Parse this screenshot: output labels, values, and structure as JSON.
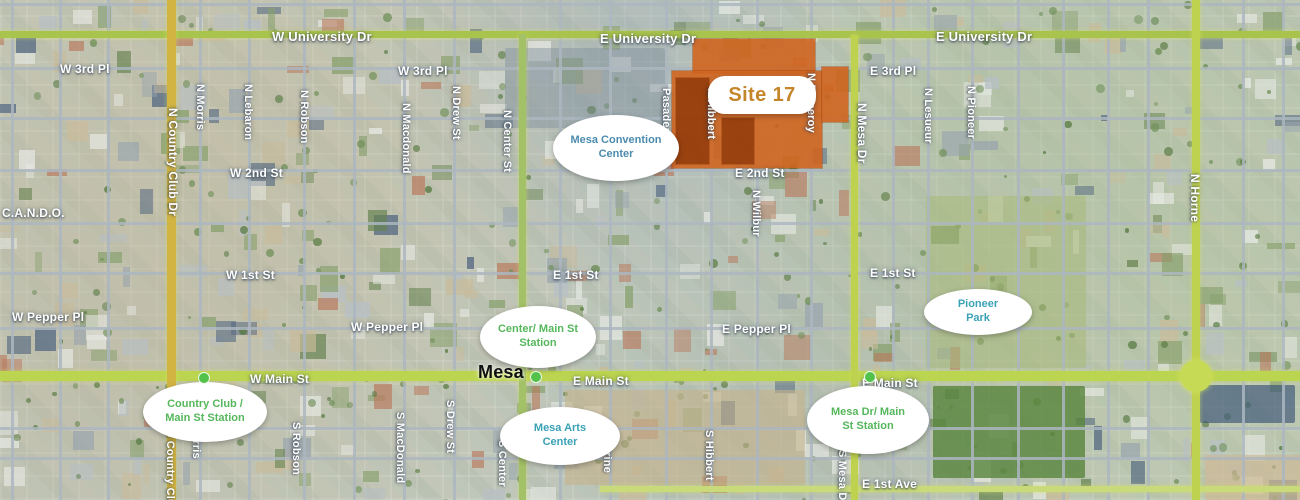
{
  "map": {
    "colors": {
      "site_fill": "#d2631c",
      "site_dark": "#933c0c",
      "site_label_text": "#c5862b",
      "station_green": "#56b75c",
      "station_dot": "#53c24a",
      "teal_label": "#3ba2b5",
      "convention_blue": "#4c8bad",
      "main_road": "#bcd550",
      "university_road": "#a9c44d",
      "gold_road": "#d2b442",
      "minor_road": "#acb6c0"
    },
    "site": {
      "label": "Site 17",
      "label_x": 762,
      "label_y": 95,
      "label_w": 92,
      "label_h": 34,
      "rects": [
        {
          "x": 693,
          "y": 39,
          "w": 122,
          "h": 34,
          "tone": "fill"
        },
        {
          "x": 672,
          "y": 71,
          "w": 150,
          "h": 97,
          "tone": "fill"
        },
        {
          "x": 822,
          "y": 67,
          "w": 26,
          "h": 55,
          "tone": "fill"
        },
        {
          "x": 676,
          "y": 78,
          "w": 33,
          "h": 86,
          "tone": "dark"
        },
        {
          "x": 722,
          "y": 118,
          "w": 32,
          "h": 46,
          "tone": "dark"
        }
      ]
    },
    "roads": [
      {
        "name": "university-dr",
        "dir": "h",
        "x": 0,
        "y": 31,
        "len": 1300,
        "th": 7,
        "color": "#a9c44d"
      },
      {
        "name": "main-st",
        "dir": "h",
        "x": 0,
        "y": 371,
        "len": 1300,
        "th": 10,
        "color": "#bcd550"
      },
      {
        "name": "e-1st-ave",
        "dir": "h",
        "x": 600,
        "y": 486,
        "len": 700,
        "th": 6,
        "color": "#c8da7a"
      },
      {
        "name": "country-club-dr",
        "dir": "v",
        "x": 167,
        "y": 0,
        "len": 500,
        "th": 9,
        "color": "#d2b442"
      },
      {
        "name": "center-st",
        "dir": "v",
        "x": 519,
        "y": 34,
        "len": 466,
        "th": 7,
        "color": "#a3c167"
      },
      {
        "name": "mesa-dr",
        "dir": "v",
        "x": 851,
        "y": 35,
        "len": 465,
        "th": 7,
        "color": "#bfd24f"
      },
      {
        "name": "horne",
        "dir": "v",
        "x": 1192,
        "y": 0,
        "len": 500,
        "th": 8,
        "color": "#bfd24f"
      }
    ],
    "roundabout": {
      "name": "main-horne-interchange",
      "x": 1196,
      "y": 376,
      "r": 16,
      "color": "#c6da55"
    },
    "grid": {
      "vertical_x": [
        12,
        60,
        108,
        200,
        249,
        304,
        354,
        404,
        454,
        560,
        610,
        666,
        711,
        757,
        811,
        893,
        928,
        972,
        1018,
        1063,
        1108,
        1148,
        1243,
        1283
      ],
      "horizontal_y": [
        4,
        68,
        118,
        170,
        223,
        273,
        328,
        428,
        458
      ]
    },
    "areas": [
      {
        "name": "convention-center-block",
        "x": 505,
        "y": 48,
        "w": 160,
        "h": 80,
        "color": "rgba(128,144,158,0.45)",
        "pattern": ""
      },
      {
        "name": "pioneer-park-area",
        "x": 926,
        "y": 196,
        "w": 160,
        "h": 172,
        "color": "rgba(168,185,120,0.55)",
        "pattern": "park"
      },
      {
        "name": "temple-gardens",
        "x": 933,
        "y": 386,
        "w": 152,
        "h": 92,
        "color": "rgba(88,132,60,0.80)",
        "pattern": "grid"
      },
      {
        "name": "vacant-lot",
        "x": 565,
        "y": 390,
        "w": 240,
        "h": 95,
        "color": "rgba(199,178,138,0.60)",
        "pattern": ""
      },
      {
        "name": "dark-roof-cluster",
        "x": 1200,
        "y": 385,
        "w": 95,
        "h": 38,
        "color": "rgba(58,84,120,0.65)",
        "pattern": ""
      },
      {
        "name": "dirt-field",
        "x": 1205,
        "y": 455,
        "w": 95,
        "h": 45,
        "color": "rgba(205,185,150,0.70)",
        "pattern": ""
      }
    ],
    "street_labels": [
      {
        "text": "W University Dr",
        "x": 272,
        "y": 29,
        "dir": "h",
        "size": 13,
        "style": "road"
      },
      {
        "text": "E University Dr",
        "x": 600,
        "y": 31,
        "dir": "h",
        "size": 13,
        "style": "road"
      },
      {
        "text": "E University Dr",
        "x": 936,
        "y": 29,
        "dir": "h",
        "size": 13,
        "style": "road"
      },
      {
        "text": "W 3rd Pl",
        "x": 60,
        "y": 62,
        "dir": "h",
        "size": 12,
        "style": "road"
      },
      {
        "text": "W 3rd Pl",
        "x": 398,
        "y": 64,
        "dir": "h",
        "size": 12,
        "style": "road"
      },
      {
        "text": "E 3rd Pl",
        "x": 870,
        "y": 64,
        "dir": "h",
        "size": 12,
        "style": "road"
      },
      {
        "text": "W 2nd St",
        "x": 230,
        "y": 166,
        "dir": "h",
        "size": 12,
        "style": "road"
      },
      {
        "text": "E 2nd St",
        "x": 735,
        "y": 166,
        "dir": "h",
        "size": 12,
        "style": "road"
      },
      {
        "text": "W 1st St",
        "x": 226,
        "y": 268,
        "dir": "h",
        "size": 12,
        "style": "road"
      },
      {
        "text": "E 1st St",
        "x": 553,
        "y": 268,
        "dir": "h",
        "size": 12,
        "style": "road"
      },
      {
        "text": "E 1st St",
        "x": 870,
        "y": 266,
        "dir": "h",
        "size": 12,
        "style": "road"
      },
      {
        "text": "C.A.N.D.O.",
        "x": 2,
        "y": 206,
        "dir": "h",
        "size": 12,
        "style": "road"
      },
      {
        "text": "W Pepper Pl",
        "x": 12,
        "y": 310,
        "dir": "h",
        "size": 12,
        "style": "road"
      },
      {
        "text": "W Pepper Pl",
        "x": 351,
        "y": 320,
        "dir": "h",
        "size": 12,
        "style": "road"
      },
      {
        "text": "E Pepper Pl",
        "x": 722,
        "y": 322,
        "dir": "h",
        "size": 12,
        "style": "road"
      },
      {
        "text": "W Main St",
        "x": 250,
        "y": 372,
        "dir": "h",
        "size": 12,
        "style": "road"
      },
      {
        "text": "E Main St",
        "x": 573,
        "y": 374,
        "dir": "h",
        "size": 12,
        "style": "road"
      },
      {
        "text": "E Main St",
        "x": 862,
        "y": 376,
        "dir": "h",
        "size": 12,
        "style": "road"
      },
      {
        "text": "E 1st Ave",
        "x": 862,
        "y": 477,
        "dir": "h",
        "size": 12,
        "style": "road"
      },
      {
        "text": "Mesa",
        "x": 478,
        "y": 362,
        "dir": "h",
        "size": 18,
        "style": "city"
      },
      {
        "text": "N Country Club Dr",
        "x": 166,
        "y": 108,
        "dir": "v",
        "size": 12,
        "style": "road"
      },
      {
        "text": "N Morris",
        "x": 194,
        "y": 84,
        "dir": "v",
        "size": 11,
        "style": "road"
      },
      {
        "text": "N Lebaron",
        "x": 242,
        "y": 84,
        "dir": "v",
        "size": 11,
        "style": "road"
      },
      {
        "text": "N Robson",
        "x": 298,
        "y": 90,
        "dir": "v",
        "size": 11,
        "style": "road"
      },
      {
        "text": "N Macdonald",
        "x": 400,
        "y": 103,
        "dir": "v",
        "size": 11,
        "style": "road"
      },
      {
        "text": "N Drew St",
        "x": 450,
        "y": 86,
        "dir": "v",
        "size": 11,
        "style": "road"
      },
      {
        "text": "N Center St",
        "x": 501,
        "y": 110,
        "dir": "v",
        "size": 11,
        "style": "road"
      },
      {
        "text": "Pasadena",
        "x": 660,
        "y": 88,
        "dir": "v",
        "size": 11,
        "style": "road"
      },
      {
        "text": "N Hibbert",
        "x": 705,
        "y": 88,
        "dir": "v",
        "size": 11,
        "style": "road"
      },
      {
        "text": "N Pomeroy",
        "x": 805,
        "y": 73,
        "dir": "v",
        "size": 11,
        "style": "road"
      },
      {
        "text": "N Mesa Dr",
        "x": 855,
        "y": 103,
        "dir": "v",
        "size": 12,
        "style": "road"
      },
      {
        "text": "N Wilbur",
        "x": 750,
        "y": 190,
        "dir": "v",
        "size": 11,
        "style": "road"
      },
      {
        "text": "N Lesueur",
        "x": 922,
        "y": 88,
        "dir": "v",
        "size": 11,
        "style": "road"
      },
      {
        "text": "N Pioneer",
        "x": 965,
        "y": 86,
        "dir": "v",
        "size": 11,
        "style": "road"
      },
      {
        "text": "N Horne",
        "x": 1188,
        "y": 174,
        "dir": "v",
        "size": 12,
        "style": "road"
      },
      {
        "text": "S Country Club",
        "x": 164,
        "y": 430,
        "dir": "v",
        "size": 11,
        "style": "road"
      },
      {
        "text": "Morris",
        "x": 190,
        "y": 424,
        "dir": "v",
        "size": 11,
        "style": "road"
      },
      {
        "text": "S Robson",
        "x": 290,
        "y": 422,
        "dir": "v",
        "size": 11,
        "style": "road"
      },
      {
        "text": "S MacDonald",
        "x": 394,
        "y": 412,
        "dir": "v",
        "size": 11,
        "style": "road"
      },
      {
        "text": "S Drew St",
        "x": 444,
        "y": 400,
        "dir": "v",
        "size": 11,
        "style": "road"
      },
      {
        "text": "S Center",
        "x": 496,
        "y": 440,
        "dir": "v",
        "size": 11,
        "style": "road"
      },
      {
        "text": "S Sirrine",
        "x": 601,
        "y": 426,
        "dir": "v",
        "size": 11,
        "style": "road"
      },
      {
        "text": "S Hibbert",
        "x": 703,
        "y": 430,
        "dir": "v",
        "size": 11,
        "style": "road"
      },
      {
        "text": "S Mesa Dr",
        "x": 836,
        "y": 450,
        "dir": "v",
        "size": 11,
        "style": "road"
      }
    ],
    "callouts": [
      {
        "id": "mesa-convention-center",
        "lines": [
          "Mesa Convention",
          "Center"
        ],
        "x": 616,
        "y": 148,
        "w": 110,
        "h": 62,
        "color_key": "convention_blue",
        "shape": "oval"
      },
      {
        "id": "site-17-label",
        "lines": [
          "Site 17"
        ],
        "x": 762,
        "y": 95,
        "w": 92,
        "h": 34,
        "color_key": "site_label_text",
        "shape": "pill"
      },
      {
        "id": "country-club-main-st-station",
        "lines": [
          "Country Club /",
          "Main St Station"
        ],
        "x": 205,
        "y": 412,
        "w": 108,
        "h": 56,
        "color_key": "station_green",
        "shape": "oval"
      },
      {
        "id": "center-main-st-station",
        "lines": [
          "Center/ Main St",
          "Station"
        ],
        "x": 538,
        "y": 337,
        "w": 100,
        "h": 58,
        "color_key": "station_green",
        "shape": "oval"
      },
      {
        "id": "mesa-arts-center",
        "lines": [
          "Mesa Arts",
          "Center"
        ],
        "x": 560,
        "y": 436,
        "w": 104,
        "h": 54,
        "color_key": "teal_label",
        "shape": "oval"
      },
      {
        "id": "mesa-dr-main-st-station",
        "lines": [
          "Mesa Dr/ Main",
          "St Station"
        ],
        "x": 868,
        "y": 420,
        "w": 106,
        "h": 64,
        "color_key": "station_green",
        "shape": "oval"
      },
      {
        "id": "pioneer-park",
        "lines": [
          "Pioneer",
          "Park"
        ],
        "x": 978,
        "y": 312,
        "w": 92,
        "h": 42,
        "color_key": "teal_label",
        "shape": "oval"
      }
    ],
    "stations": [
      {
        "name": "country-club-station-dot",
        "x": 204,
        "y": 378
      },
      {
        "name": "center-station-dot",
        "x": 536,
        "y": 377
      },
      {
        "name": "mesa-dr-station-dot",
        "x": 870,
        "y": 377
      }
    ]
  }
}
